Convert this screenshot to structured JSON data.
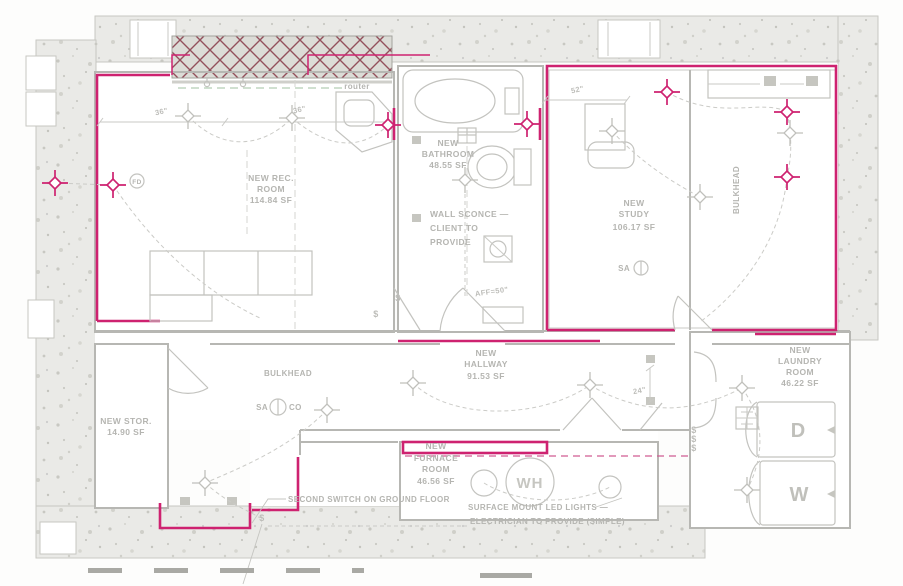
{
  "drawing": {
    "kind": "basement lighting and electrical floor plan",
    "colors": {
      "new_construction": "#ce2270",
      "existing_walls": "#b7b7b3",
      "annotation_text": "#b5b5b1",
      "site_texture": "#eaeae7",
      "hatch_lines": "#93505c",
      "cable_route_green": "#b3ceb3"
    }
  },
  "rooms": {
    "rec": {
      "l1": "NEW REC.",
      "l2": "ROOM",
      "area": "114.84 SF"
    },
    "bathroom": {
      "l1": "NEW",
      "l2": "BATHROOM",
      "area": "48.55 SF"
    },
    "study": {
      "l1": "NEW",
      "l2": "STUDY",
      "area": "106.17 SF"
    },
    "hallway": {
      "l1": "NEW",
      "l2": "HALLWAY",
      "area": "91.53 SF"
    },
    "laundry": {
      "l1": "NEW",
      "l2": "LAUNDRY",
      "l3": "ROOM",
      "area": "46.22 SF"
    },
    "storage": {
      "l1": "NEW STOR.",
      "area": "14.90 SF"
    },
    "furnace": {
      "l1": "NEW",
      "l2": "FURNACE",
      "l3": "ROOM",
      "area": "46.56 SF"
    }
  },
  "notes": {
    "router": "router",
    "wall_sconce_l1": "WALL SCONCE —",
    "wall_sconce_l2": "CLIENT TO",
    "wall_sconce_l3": "PROVIDE",
    "aff": "AFF=50\"",
    "bulkhead_hall": "BULKHEAD",
    "bulkhead_study": "BULKHEAD",
    "second_switch": "SECOND SWITCH ON GROUND FLOOR",
    "led_l1": "SURFACE MOUNT LED LIGHTS —",
    "led_l2": "ELECTRICIAN TO PROVIDE (SIMPLE)"
  },
  "dimensions": {
    "dim_36_a": "36\"",
    "dim_36_b": "36\"",
    "dim_52": "52\"",
    "dim_24": "24\""
  },
  "labels": {
    "water_heater": "WH",
    "dryer": "D",
    "washer": "W",
    "floor_drain": "FD",
    "smoke_alarm": "SA",
    "carbon_monoxide": "CO",
    "smoke_alarm_study": "SA",
    "switch": "$"
  }
}
